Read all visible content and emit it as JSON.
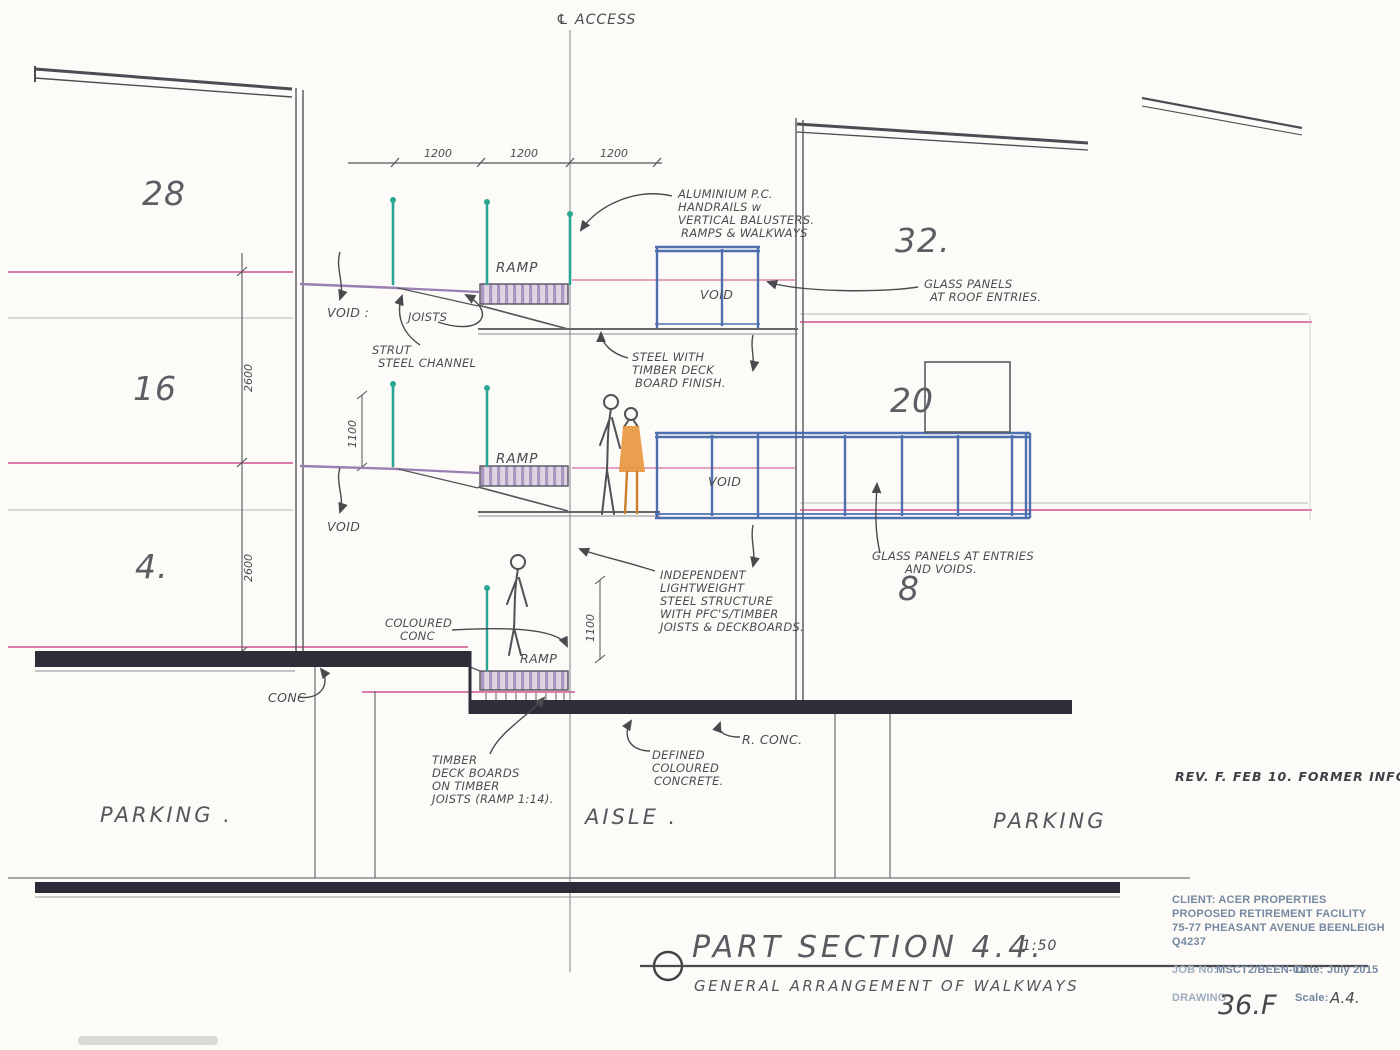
{
  "colors": {
    "paper": "#fcfbf8",
    "pencil": "#5b5b60",
    "pink_level_line": "#d2679b",
    "blue_walkway": "#3f63aa",
    "teal_baluster": "#2ba493",
    "purple_deck": "#9a7fb5",
    "slab_dark": "#2e2e3a",
    "orange_figure": "#e8953c",
    "titleblock_print": "#7488a1"
  },
  "drawing": {
    "access_label": "℄ ACCESS",
    "dims": {
      "top": [
        "1200",
        "1200",
        "1200"
      ],
      "left": [
        "2600",
        "2600"
      ],
      "small": [
        "1100",
        "1100"
      ]
    },
    "unit_numbers": {
      "n28": "28",
      "n16": "16",
      "n4": "4.",
      "n32": "32.",
      "n20": "20",
      "n8": "8"
    },
    "ramps": [
      "RAMP",
      "RAMP",
      "RAMP"
    ],
    "voids": {
      "left_top": "VOID :",
      "left_mid": "VOID",
      "box_top": "VOID",
      "box_mid": "VOID"
    },
    "notes": {
      "handrails": {
        "lines": [
          "ALUMINIUM P.C.",
          "HANDRAILS w",
          "VERTICAL BALUSTERS.",
          "RAMPS & WALKWAYS"
        ]
      },
      "glass_roof": {
        "lines": [
          "GLASS PANELS",
          "AT ROOF ENTRIES."
        ]
      },
      "strut": {
        "lines": [
          "STRUT",
          "STEEL CHANNEL"
        ]
      },
      "joists": "JOISTS",
      "steel_timber": {
        "lines": [
          "STEEL WITH",
          "TIMBER DECK",
          "BOARD FINISH."
        ]
      },
      "glass_entries": {
        "lines": [
          "GLASS PANELS AT ENTRIES",
          "AND VOIDS."
        ]
      },
      "independent": {
        "lines": [
          "INDEPENDENT",
          "LIGHTWEIGHT",
          "STEEL STRUCTURE",
          "WITH PFC'S/TIMBER",
          "JOISTS & DECKBOARDS."
        ]
      },
      "coloured_conc": {
        "lines": [
          "COLOURED",
          "CONC"
        ]
      },
      "conc": "CONC",
      "timber_deck": {
        "lines": [
          "TIMBER",
          "DECK BOARDS",
          "ON TIMBER",
          "JOISTS (RAMP 1:14)."
        ]
      },
      "defined_conc": {
        "lines": [
          "DEFINED",
          "COLOURED",
          "CONCRETE."
        ]
      },
      "r_conc": "R. CONC."
    },
    "zones": {
      "parking_left": "PARKING .",
      "aisle": "AISLE .",
      "parking_right": "PARKING"
    },
    "revision": "REV. F.    FEB 10.    FORMER INFO"
  },
  "title": {
    "name": "PART SECTION 4.4.",
    "scale": "1:50",
    "subtitle": "GENERAL ARRANGEMENT OF WALKWAYS"
  },
  "title_block": {
    "client_lines": [
      "CLIENT: ACER PROPERTIES",
      "PROPOSED RETIREMENT FACILITY",
      "75-77 PHEASANT AVENUE BEENLEIGH",
      "Q4237"
    ],
    "job_label": "JOB No:",
    "job_value": "MSCT2/BEEN-01",
    "date_label": "Date:",
    "date_value": "July 2015",
    "drawing_label": "DRAWING",
    "drawing_value": "36.F",
    "scale_label": "Scale:",
    "scale_value": "A.4."
  }
}
